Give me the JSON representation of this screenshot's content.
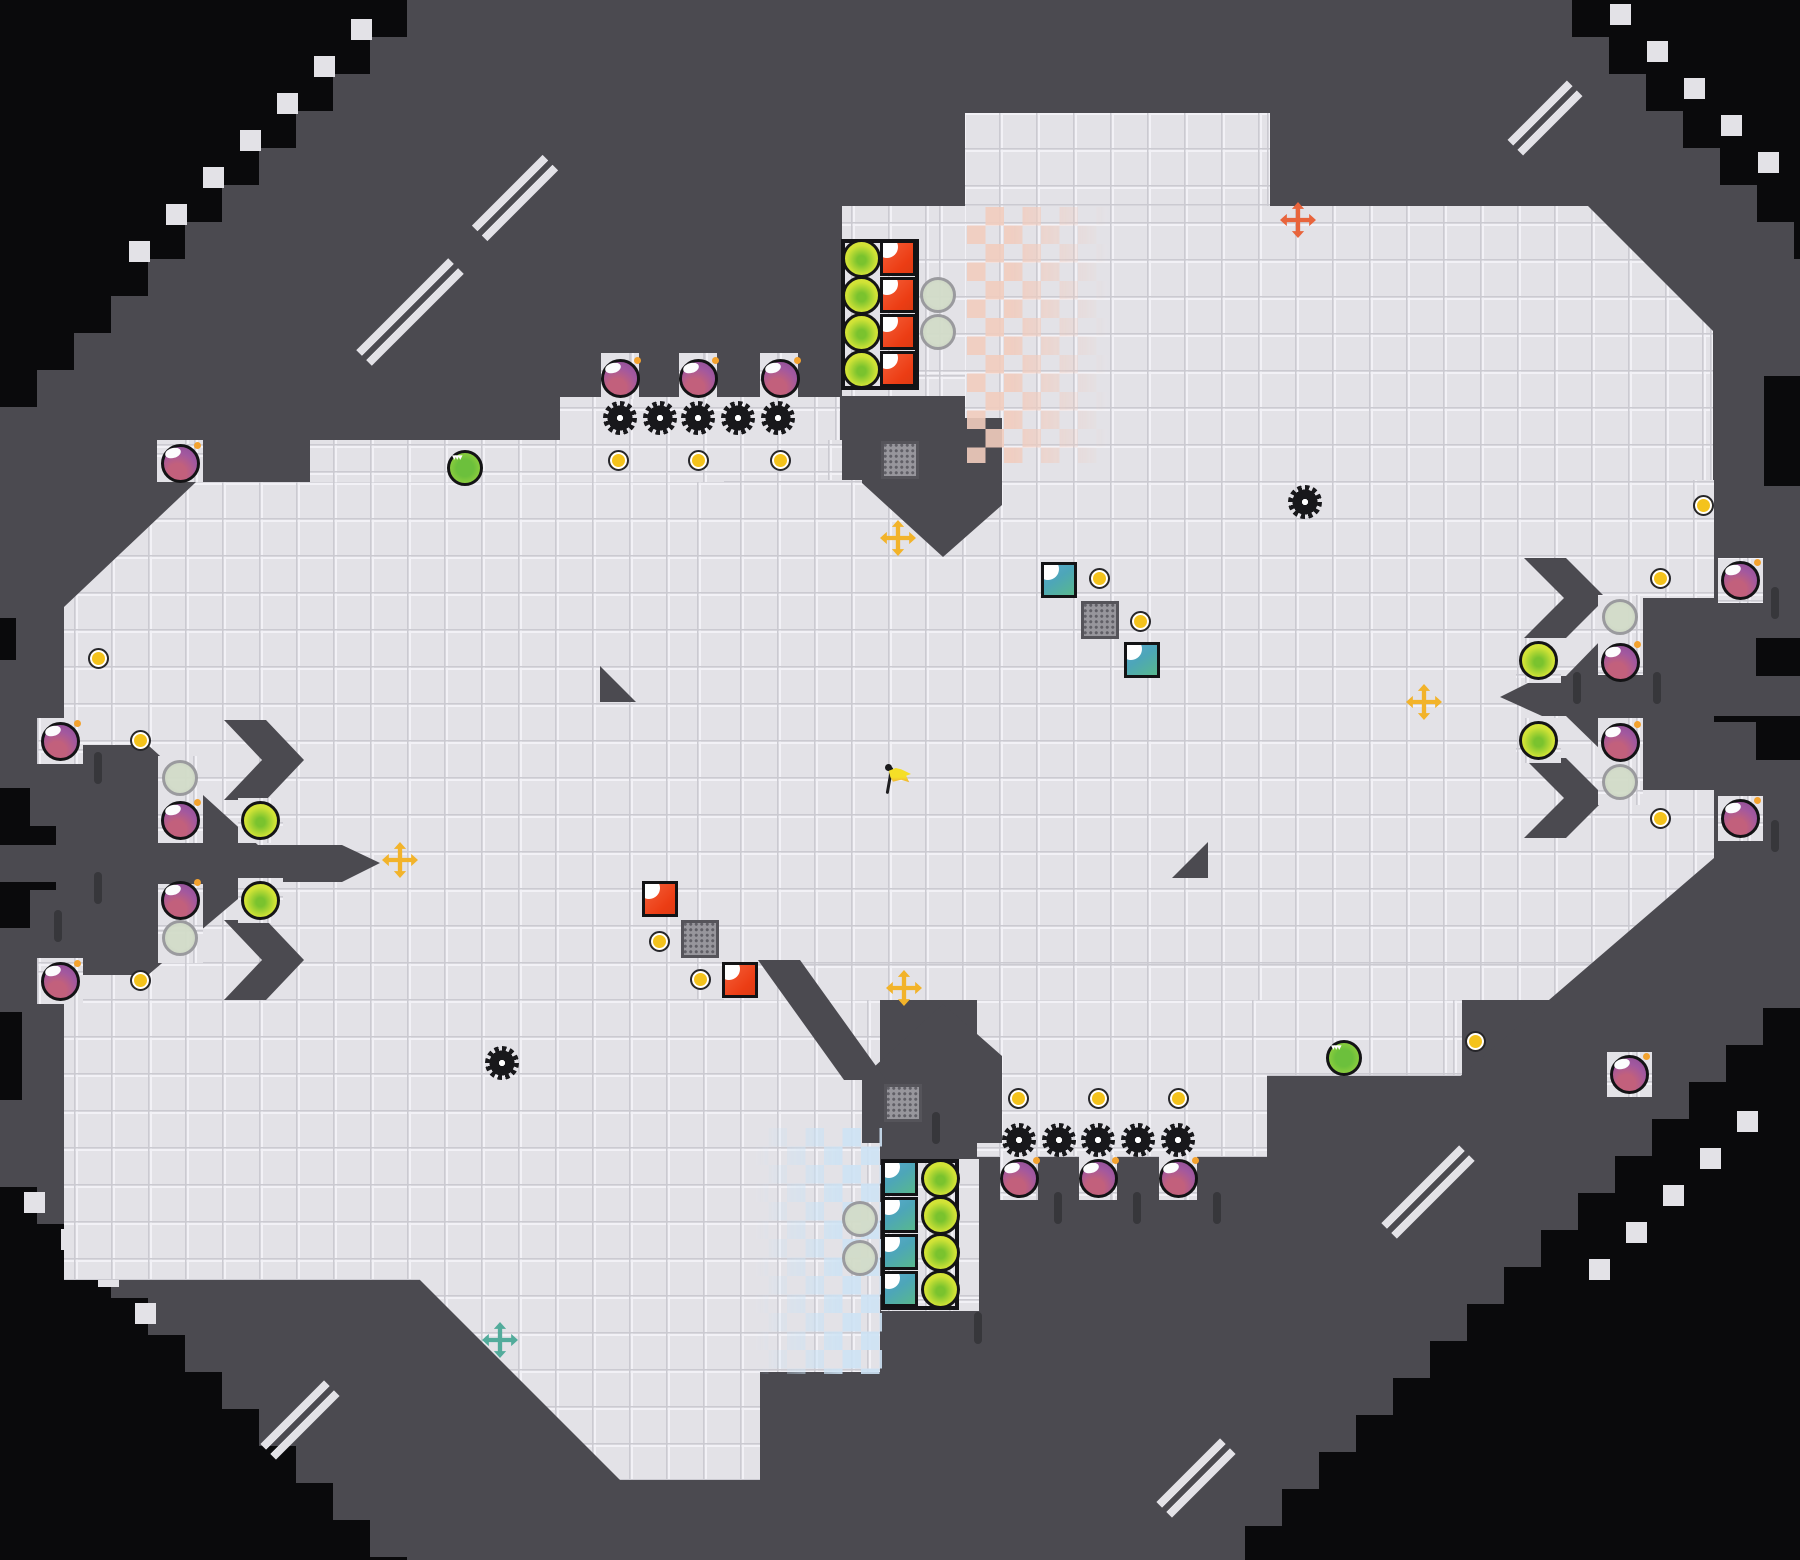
{
  "palette": {
    "void": "#0a0a0c",
    "wall": "#4b4a50",
    "floor": "#e3e2e7",
    "checker_red": "#f1ccbe",
    "checker_blue": "#cde3f4",
    "cross_yellow": "#f2b32a",
    "cross_orange": "#e8643c",
    "cross_teal": "#52ab9b",
    "bomb_purple": "#9b5aa8",
    "orb_green": "#cfe236",
    "coin_yellow": "#f4c31c",
    "red_square": "#ee4a26",
    "teal_square": "#4da6b8",
    "pale_circle": "#ccd5c4",
    "grate_gray": "#97969c",
    "gear_black": "#18181b",
    "flag_yellow": "#f5df27"
  },
  "map": {
    "grid": 37,
    "floors": [
      [
        842,
        206,
        125,
        190
      ],
      [
        965,
        113,
        305,
        93
      ],
      [
        965,
        206,
        748,
        352
      ],
      [
        560,
        397,
        280,
        85
      ],
      [
        601,
        353,
        38,
        46
      ],
      [
        679,
        353,
        38,
        46
      ],
      [
        760,
        353,
        38,
        46
      ],
      [
        310,
        440,
        532,
        64
      ],
      [
        157,
        440,
        46,
        46
      ],
      [
        64,
        482,
        660,
        798
      ],
      [
        724,
        480,
        990,
        520
      ],
      [
        420,
        1000,
        460,
        480
      ],
      [
        881,
        1159,
        98,
        152
      ],
      [
        977,
        1000,
        290,
        157
      ],
      [
        1000,
        1155,
        38,
        45
      ],
      [
        1079,
        1155,
        38,
        45
      ],
      [
        1159,
        1155,
        38,
        45
      ],
      [
        1267,
        1000,
        195,
        76
      ]
    ],
    "pockets": [
      [
        37,
        718,
        46,
        46
      ],
      [
        37,
        958,
        46,
        46
      ],
      [
        158,
        756,
        45,
        87
      ],
      [
        158,
        884,
        45,
        79
      ],
      [
        238,
        798,
        45,
        45
      ],
      [
        238,
        878,
        45,
        45
      ],
      [
        1598,
        595,
        45,
        80
      ],
      [
        1598,
        718,
        45,
        87
      ],
      [
        1516,
        638,
        45,
        45
      ],
      [
        1516,
        718,
        45,
        45
      ],
      [
        1718,
        558,
        45,
        45
      ],
      [
        1718,
        796,
        45,
        45
      ],
      [
        1607,
        1052,
        45,
        45
      ]
    ],
    "wall_polys": [
      [
        [
          1588,
          206
        ],
        [
          1713,
          206
        ],
        [
          1713,
          331
        ]
      ],
      [
        [
          862,
          418
        ],
        [
          1002,
          418
        ],
        [
          1002,
          505
        ],
        [
          943,
          557
        ],
        [
          862,
          483
        ]
      ],
      [
        [
          1500,
          697
        ],
        [
          1542,
          676
        ],
        [
          1800,
          676
        ],
        [
          1800,
          716
        ],
        [
          1542,
          716
        ]
      ],
      [
        [
          1642,
          598
        ],
        [
          1714,
          598
        ],
        [
          1714,
          676
        ],
        [
          1566,
          676
        ]
      ],
      [
        [
          1566,
          716
        ],
        [
          1714,
          716
        ],
        [
          1714,
          790
        ],
        [
          1642,
          790
        ]
      ],
      [
        [
          1524,
          558
        ],
        [
          1566,
          558
        ],
        [
          1606,
          598
        ],
        [
          1566,
          638
        ],
        [
          1524,
          638
        ],
        [
          1564,
          598
        ]
      ],
      [
        [
          1524,
          758
        ],
        [
          1566,
          758
        ],
        [
          1606,
          798
        ],
        [
          1566,
          838
        ],
        [
          1524,
          838
        ],
        [
          1564,
          798
        ]
      ],
      [
        [
          0,
          845
        ],
        [
          342,
          845
        ],
        [
          380,
          863
        ],
        [
          342,
          882
        ],
        [
          0,
          882
        ]
      ],
      [
        [
          64,
          745
        ],
        [
          148,
          745
        ],
        [
          258,
          845
        ],
        [
          64,
          845
        ]
      ],
      [
        [
          64,
          882
        ],
        [
          258,
          882
        ],
        [
          148,
          975
        ],
        [
          64,
          975
        ]
      ],
      [
        [
          224,
          720
        ],
        [
          266,
          720
        ],
        [
          304,
          760
        ],
        [
          266,
          800
        ],
        [
          224,
          800
        ],
        [
          262,
          760
        ]
      ],
      [
        [
          224,
          920
        ],
        [
          266,
          920
        ],
        [
          304,
          960
        ],
        [
          266,
          1000
        ],
        [
          224,
          1000
        ],
        [
          262,
          960
        ]
      ],
      [
        [
          64,
          482
        ],
        [
          196,
          482
        ],
        [
          64,
          607
        ]
      ],
      [
        [
          600,
          666
        ],
        [
          600,
          702
        ],
        [
          636,
          702
        ]
      ],
      [
        [
          1172,
          878
        ],
        [
          1208,
          878
        ],
        [
          1208,
          842
        ]
      ],
      [
        [
          420,
          1280
        ],
        [
          420,
          1480
        ],
        [
          620,
          1480
        ]
      ],
      [
        [
          1714,
          858
        ],
        [
          1714,
          1080
        ],
        [
          1456,
          1080
        ]
      ],
      [
        [
          862,
          1078
        ],
        [
          943,
          1004
        ],
        [
          1002,
          1056
        ],
        [
          1002,
          1143
        ],
        [
          862,
          1143
        ]
      ],
      [
        [
          758,
          960
        ],
        [
          800,
          960
        ],
        [
          886,
          1080
        ],
        [
          844,
          1080
        ]
      ]
    ],
    "wall_rects": [
      [
        760,
        1372,
        120,
        108
      ]
    ],
    "void_stairs": [
      {
        "corner": "tl",
        "ext": 407
      },
      {
        "corner": "tr",
        "x0": 1572
      },
      {
        "corner": "br",
        "y0": 1008
      },
      {
        "corner": "bl",
        "y0": 1150,
        "ext": 410
      }
    ],
    "void_rects": [
      [
        0,
        788,
        30,
        140
      ],
      [
        0,
        826,
        56,
        64
      ],
      [
        1756,
        638,
        44,
        122
      ],
      [
        1714,
        676,
        86,
        46
      ],
      [
        1764,
        376,
        36,
        110
      ],
      [
        0,
        618,
        16,
        42
      ],
      [
        0,
        1012,
        22,
        88
      ]
    ],
    "steps": [
      [
        240,
        130
      ],
      [
        277,
        93
      ],
      [
        314,
        56
      ],
      [
        351,
        19
      ],
      [
        203,
        167
      ],
      [
        166,
        204
      ],
      [
        129,
        241
      ],
      [
        1610,
        4
      ],
      [
        1647,
        41
      ],
      [
        1684,
        78
      ],
      [
        1721,
        115
      ],
      [
        1758,
        152
      ],
      [
        1737,
        1111
      ],
      [
        1700,
        1148
      ],
      [
        1663,
        1185
      ],
      [
        1626,
        1222
      ],
      [
        1589,
        1259
      ],
      [
        24,
        1192
      ],
      [
        61,
        1229
      ],
      [
        98,
        1266
      ],
      [
        135,
        1303
      ]
    ],
    "slashes": [
      {
        "cx": 410,
        "cy": 312,
        "len": 130
      },
      {
        "cx": 515,
        "cy": 198,
        "len": 100
      },
      {
        "cx": 1545,
        "cy": 118,
        "len": 84
      },
      {
        "cx": 1428,
        "cy": 1192,
        "len": 110
      },
      {
        "cx": 1196,
        "cy": 1478,
        "len": 90
      },
      {
        "cx": 300,
        "cy": 1420,
        "len": 90
      }
    ],
    "ticks": [
      [
        1058,
        1208
      ],
      [
        1137,
        1208
      ],
      [
        1217,
        1208
      ],
      [
        978,
        1328
      ],
      [
        936,
        1128
      ],
      [
        1577,
        688
      ],
      [
        1657,
        688
      ],
      [
        1775,
        603
      ],
      [
        1775,
        836
      ],
      [
        98,
        768
      ],
      [
        98,
        888
      ],
      [
        58,
        926
      ]
    ],
    "checkers": [
      {
        "x": 967,
        "y": 207,
        "w": 146,
        "h": 256,
        "color": "#f1ccbe",
        "fade": "to right"
      },
      {
        "x": 750,
        "y": 1128,
        "w": 132,
        "h": 246,
        "color": "#cde3f4",
        "fade": "to left"
      }
    ],
    "outlines": [
      [
        841,
        239,
        78,
        151
      ],
      [
        881,
        1159,
        78,
        151
      ]
    ]
  },
  "entities": {
    "bombs": [
      [
        620,
        378
      ],
      [
        698,
        378
      ],
      [
        780,
        378
      ],
      [
        180,
        463
      ],
      [
        60,
        741
      ],
      [
        180,
        820
      ],
      [
        180,
        900
      ],
      [
        60,
        981
      ],
      [
        1740,
        580
      ],
      [
        1620,
        662
      ],
      [
        1620,
        742
      ],
      [
        1740,
        818
      ],
      [
        1019,
        1178
      ],
      [
        1098,
        1178
      ],
      [
        1178,
        1178
      ],
      [
        1629,
        1074
      ]
    ],
    "orbs": [
      [
        861,
        258
      ],
      [
        861,
        295
      ],
      [
        861,
        332
      ],
      [
        861,
        369
      ],
      [
        940,
        1178
      ],
      [
        940,
        1215
      ],
      [
        940,
        1252
      ],
      [
        940,
        1289
      ],
      [
        260,
        820
      ],
      [
        260,
        900
      ],
      [
        1538,
        660
      ],
      [
        1538,
        740
      ]
    ],
    "red_squares": [
      [
        898,
        258
      ],
      [
        898,
        295
      ],
      [
        898,
        332
      ],
      [
        898,
        369
      ],
      [
        660,
        899
      ],
      [
        740,
        980
      ]
    ],
    "teal_squares": [
      [
        900,
        1178
      ],
      [
        900,
        1215
      ],
      [
        900,
        1252
      ],
      [
        900,
        1289
      ],
      [
        1059,
        580
      ],
      [
        1142,
        660
      ]
    ],
    "pale_circles": [
      [
        938,
        295
      ],
      [
        938,
        332
      ],
      [
        860,
        1219
      ],
      [
        860,
        1258
      ],
      [
        180,
        778
      ],
      [
        180,
        938
      ],
      [
        1620,
        617
      ],
      [
        1620,
        782
      ]
    ],
    "coins": [
      [
        618,
        460
      ],
      [
        698,
        460
      ],
      [
        780,
        460
      ],
      [
        98,
        658
      ],
      [
        140,
        740
      ],
      [
        140,
        980
      ],
      [
        659,
        941
      ],
      [
        700,
        979
      ],
      [
        1099,
        578
      ],
      [
        1140,
        621
      ],
      [
        1660,
        578
      ],
      [
        1660,
        818
      ],
      [
        1703,
        505
      ],
      [
        1475,
        1041
      ],
      [
        1018,
        1098
      ],
      [
        1098,
        1098
      ],
      [
        1178,
        1098
      ]
    ],
    "gears": [
      [
        620,
        418
      ],
      [
        660,
        418
      ],
      [
        698,
        418
      ],
      [
        738,
        418
      ],
      [
        778,
        418
      ],
      [
        1305,
        502
      ],
      [
        502,
        1063
      ],
      [
        1019,
        1140
      ],
      [
        1059,
        1140
      ],
      [
        1098,
        1140
      ],
      [
        1138,
        1140
      ],
      [
        1178,
        1140
      ]
    ],
    "grates": [
      [
        900,
        460
      ],
      [
        700,
        939
      ],
      [
        1100,
        620
      ],
      [
        903,
        1103
      ]
    ],
    "crosses": [
      {
        "x": 1298,
        "y": 220,
        "c": "orange"
      },
      {
        "x": 898,
        "y": 538,
        "c": "yellow"
      },
      {
        "x": 1424,
        "y": 702,
        "c": "yellow"
      },
      {
        "x": 400,
        "y": 860,
        "c": "yellow"
      },
      {
        "x": 904,
        "y": 988,
        "c": "yellow"
      },
      {
        "x": 500,
        "y": 1340,
        "c": "teal"
      }
    ],
    "striped_orbs": [
      [
        465,
        468
      ],
      [
        1344,
        1058
      ]
    ],
    "flag": {
      "x": 895,
      "y": 782
    }
  }
}
